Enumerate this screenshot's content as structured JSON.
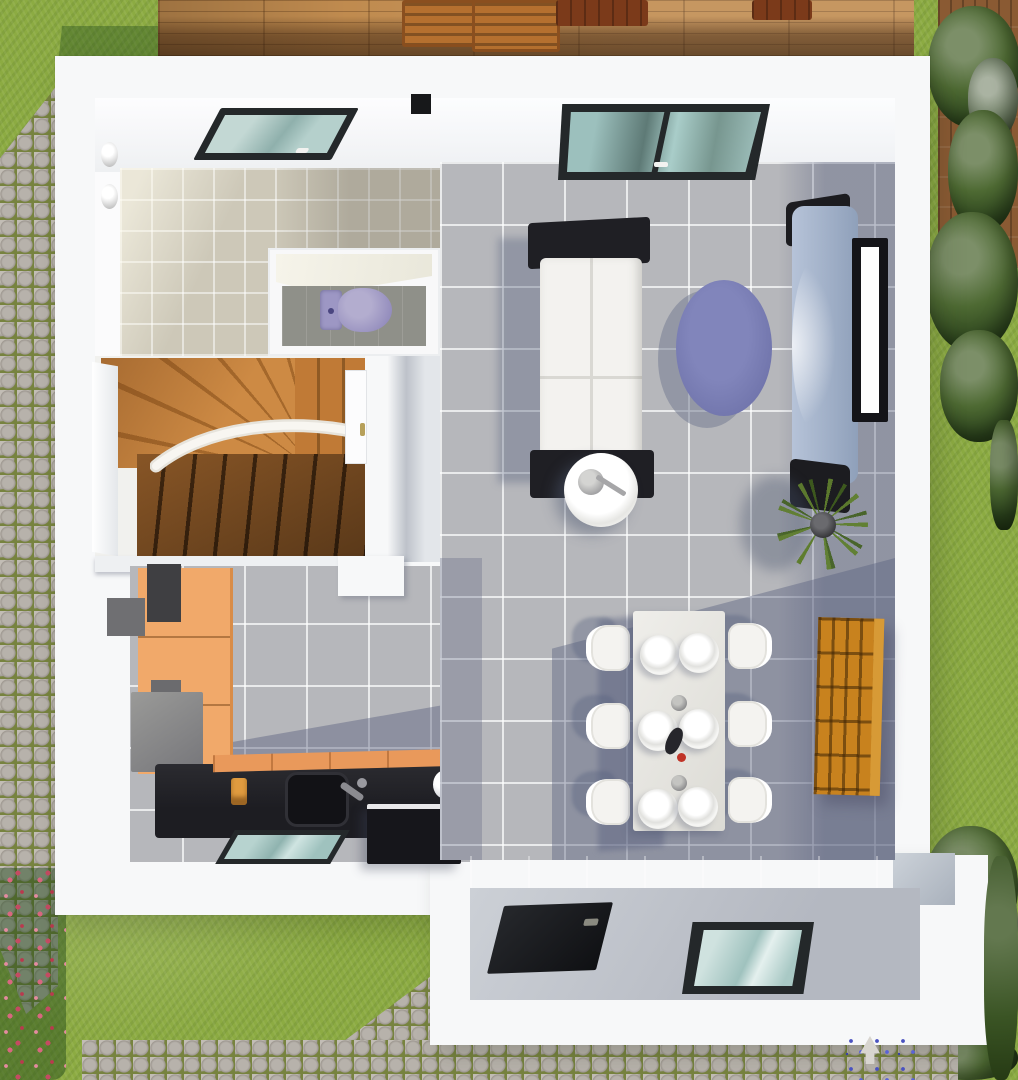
{
  "scene": {
    "title": "3D floor plan render — ground floor, top-down view",
    "style": "architectural 3D visualization",
    "lighting": "daylight with blue-grey cast shadows"
  },
  "palette": {
    "grass": "#8cab42",
    "deck_wood": "#c08b4f",
    "chair_wood": "#b5702f",
    "cobble_stone": "#b7b2ab",
    "cobble_grout": "#77833f",
    "fence": "#8a5a33",
    "wall": "#f7f8f9",
    "tile_gray": "#b6b7bb",
    "tile_beige": "#cdc8b8",
    "shadow_blue": "#586180",
    "stair_wood": "#c9813d",
    "stair_wood_dark": "#6e451d",
    "cabinet_orange": "#f1a96a",
    "counter_dark": "#1d1d22",
    "counter_edge": "#e9995b",
    "shelf_orange": "#c8821e",
    "sofa_white": "#f3f2ef",
    "sofa_frame": "#1f1f24",
    "rug_purple": "#6d71a8",
    "toilet_lavender": "#9d97c4",
    "glass_teal": "#a8c8c4",
    "frame_dark": "#24282a",
    "entrance_floor": "#c6c9cf",
    "door_dark": "#0f1013",
    "tv_console": "#b6c3d8",
    "plant_green": "#5f7e2e",
    "lamp_white": "#d8d5cf",
    "flower_pink": "#d8677f",
    "flower_red": "#b93a4e",
    "flower_blue": "#4a52c0"
  },
  "garden": {
    "label": "garden surroundings",
    "items": [
      "lawn",
      "wooden deck with two chairs and table",
      "cobblestone path (left and bottom)",
      "hedge and trees along right edge",
      "wooden fence (top right)",
      "pink flower bed (bottom left)",
      "bush with red flowers",
      "blue flowers",
      "garden lamp"
    ]
  },
  "house": {
    "label": "single-family house — ground floor",
    "rooms": {
      "bathroom": {
        "label": "bathroom",
        "items": [
          "roof window with teal glass",
          "two wall lights",
          "beige tiled floor"
        ]
      },
      "wc": {
        "label": "toilet room",
        "items": [
          "lavender toilet",
          "grey tiled floor"
        ]
      },
      "stair_hall": {
        "label": "stair hall",
        "items": [
          "wooden winder staircase",
          "white curved handrail",
          "door to living room",
          "side window"
        ]
      },
      "kitchen": {
        "label": "kitchen",
        "items": [
          "tall orange cabinets",
          "grey fridge",
          "dark counter with sink and faucet",
          "utensil pot",
          "white kettle",
          "black appliance",
          "window in south wall"
        ]
      },
      "living_dining": {
        "label": "living / dining room",
        "items": [
          "large roof window",
          "white sofa with black frame",
          "round white side table with lamp",
          "round purple rug",
          "curved TV console with black caps",
          "wall-mounted TV",
          "potted plant",
          "orange cube shelf",
          "white dining table with six place settings",
          "six white chairs",
          "wine bottle and two candles"
        ]
      },
      "entrance": {
        "label": "entrance hall",
        "items": [
          "dark front door",
          "window with teal glass"
        ]
      }
    }
  }
}
